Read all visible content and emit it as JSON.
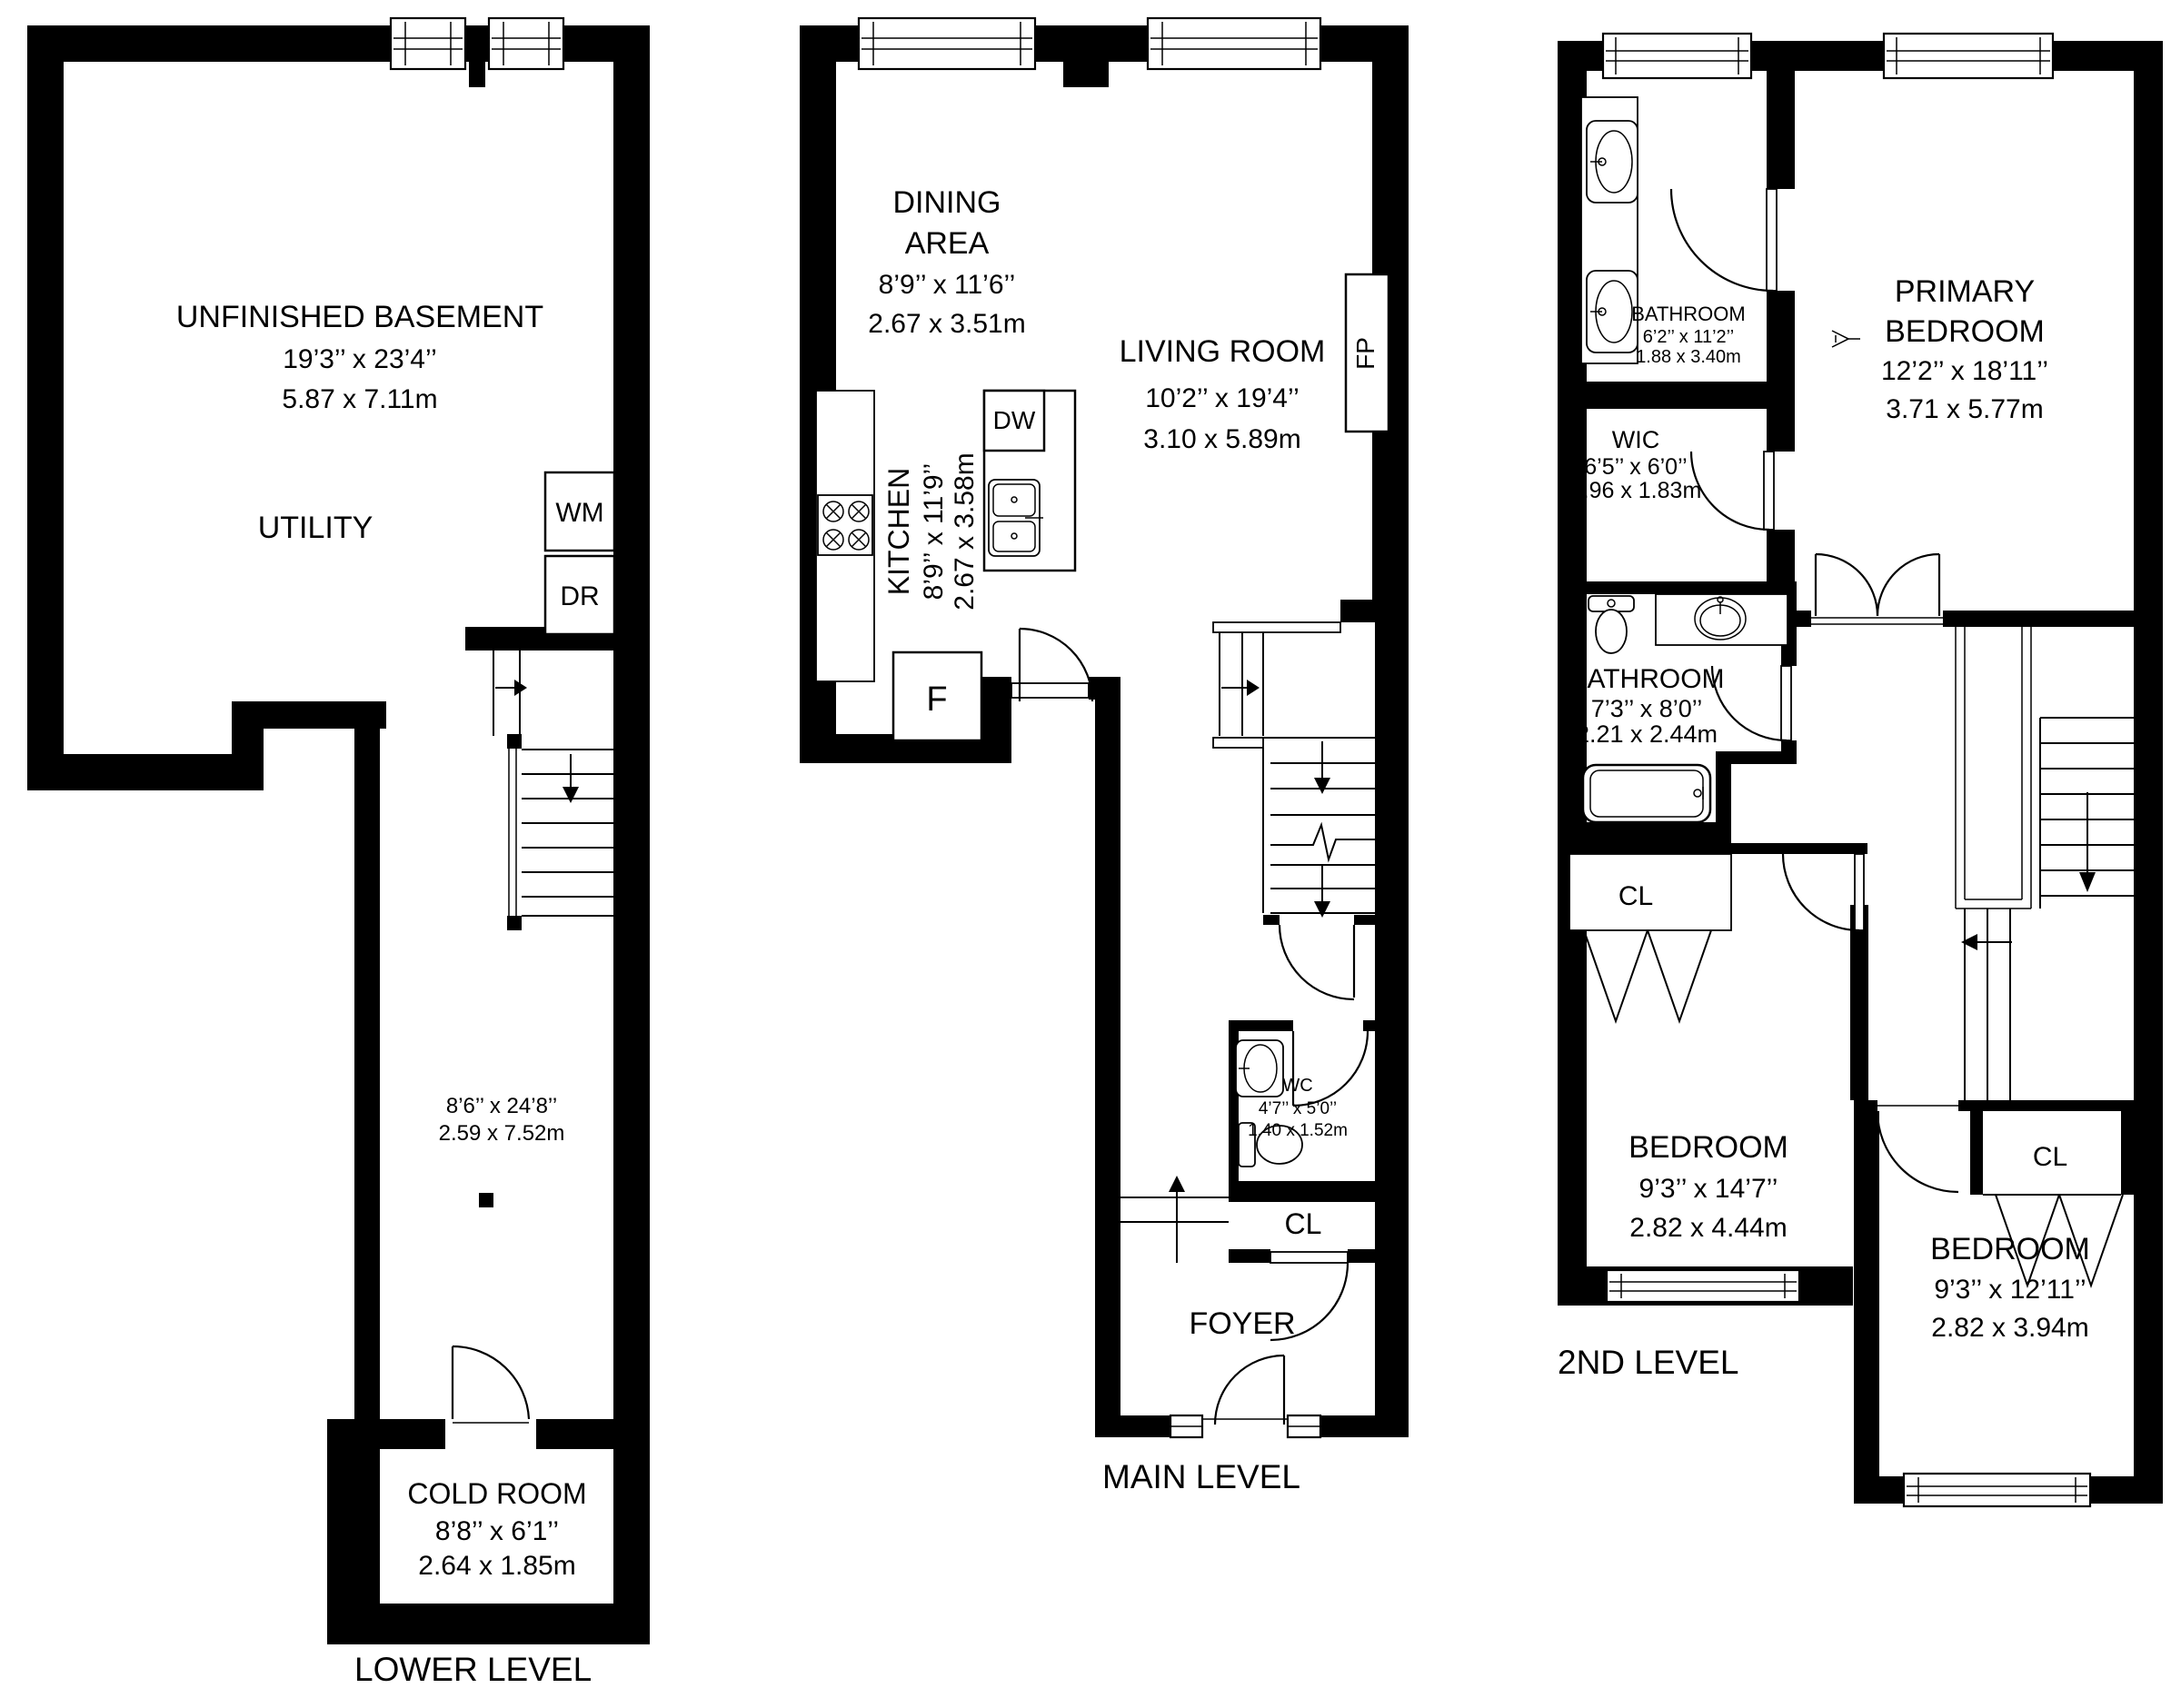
{
  "levels": {
    "lower": {
      "label": "LOWER LEVEL"
    },
    "main": {
      "label": "MAIN LEVEL"
    },
    "second": {
      "label": "2ND LEVEL"
    }
  },
  "rooms": {
    "basement": {
      "name": "UNFINISHED BASEMENT",
      "imperial": "19’3’’ x 23’4’’",
      "metric": "5.87 x 7.11m"
    },
    "utility": {
      "name": "UTILITY"
    },
    "corridor": {
      "imperial": "8’6’’ x 24’8’’",
      "metric": "2.59 x 7.52m"
    },
    "cold_room": {
      "name": "COLD ROOM",
      "imperial": "8’8’’ x 6’1’’",
      "metric": "2.64 x 1.85m"
    },
    "dining": {
      "name1": "DINING",
      "name2": "AREA",
      "imperial": "8’9’’ x 11’6’’",
      "metric": "2.67 x 3.51m"
    },
    "living": {
      "name": "LIVING ROOM",
      "imperial": "10’2’’ x 19’4’’",
      "metric": "3.10 x 5.89m"
    },
    "kitchen": {
      "name": "KITCHEN",
      "imperial": "8’9’’ x 11’9’’",
      "metric": "2.67 x 3.58m"
    },
    "wc": {
      "name": "WC",
      "imperial": "4’7’’ x 5’0’’",
      "metric": "1.40 x 1.52m"
    },
    "foyer": {
      "name": "FOYER"
    },
    "bathroom_ensuite": {
      "name": "BATHROOM",
      "imperial": "6’2’’ x 11’2’’",
      "metric": "1.88 x 3.40m"
    },
    "primary": {
      "name1": "PRIMARY",
      "name2": "BEDROOM",
      "imperial": "12’2’’ x 18’11’’",
      "metric": "3.71 x 5.77m"
    },
    "wic": {
      "name": "WIC",
      "imperial": "6’5’’ x 6’0’’",
      "metric": "1.96 x 1.83m"
    },
    "bathroom2": {
      "name": "BATHROOM",
      "imperial": "7’3’’ x 8’0’’",
      "metric": "2.21 x 2.44m"
    },
    "bedroom2": {
      "name": "BEDROOM",
      "imperial": "9’3’’ x 14’7’’",
      "metric": "2.82 x 4.44m"
    },
    "bedroom3": {
      "name": "BEDROOM",
      "imperial": "9’3’’ x 12’11’’",
      "metric": "2.82 x 3.94m"
    }
  },
  "fixtures": {
    "washer": "WM",
    "dryer": "DR",
    "fridge": "F",
    "dishwasher": "DW",
    "fireplace": "FP",
    "closet": "CL"
  },
  "colors": {
    "wall": "#000000",
    "background": "#ffffff"
  }
}
